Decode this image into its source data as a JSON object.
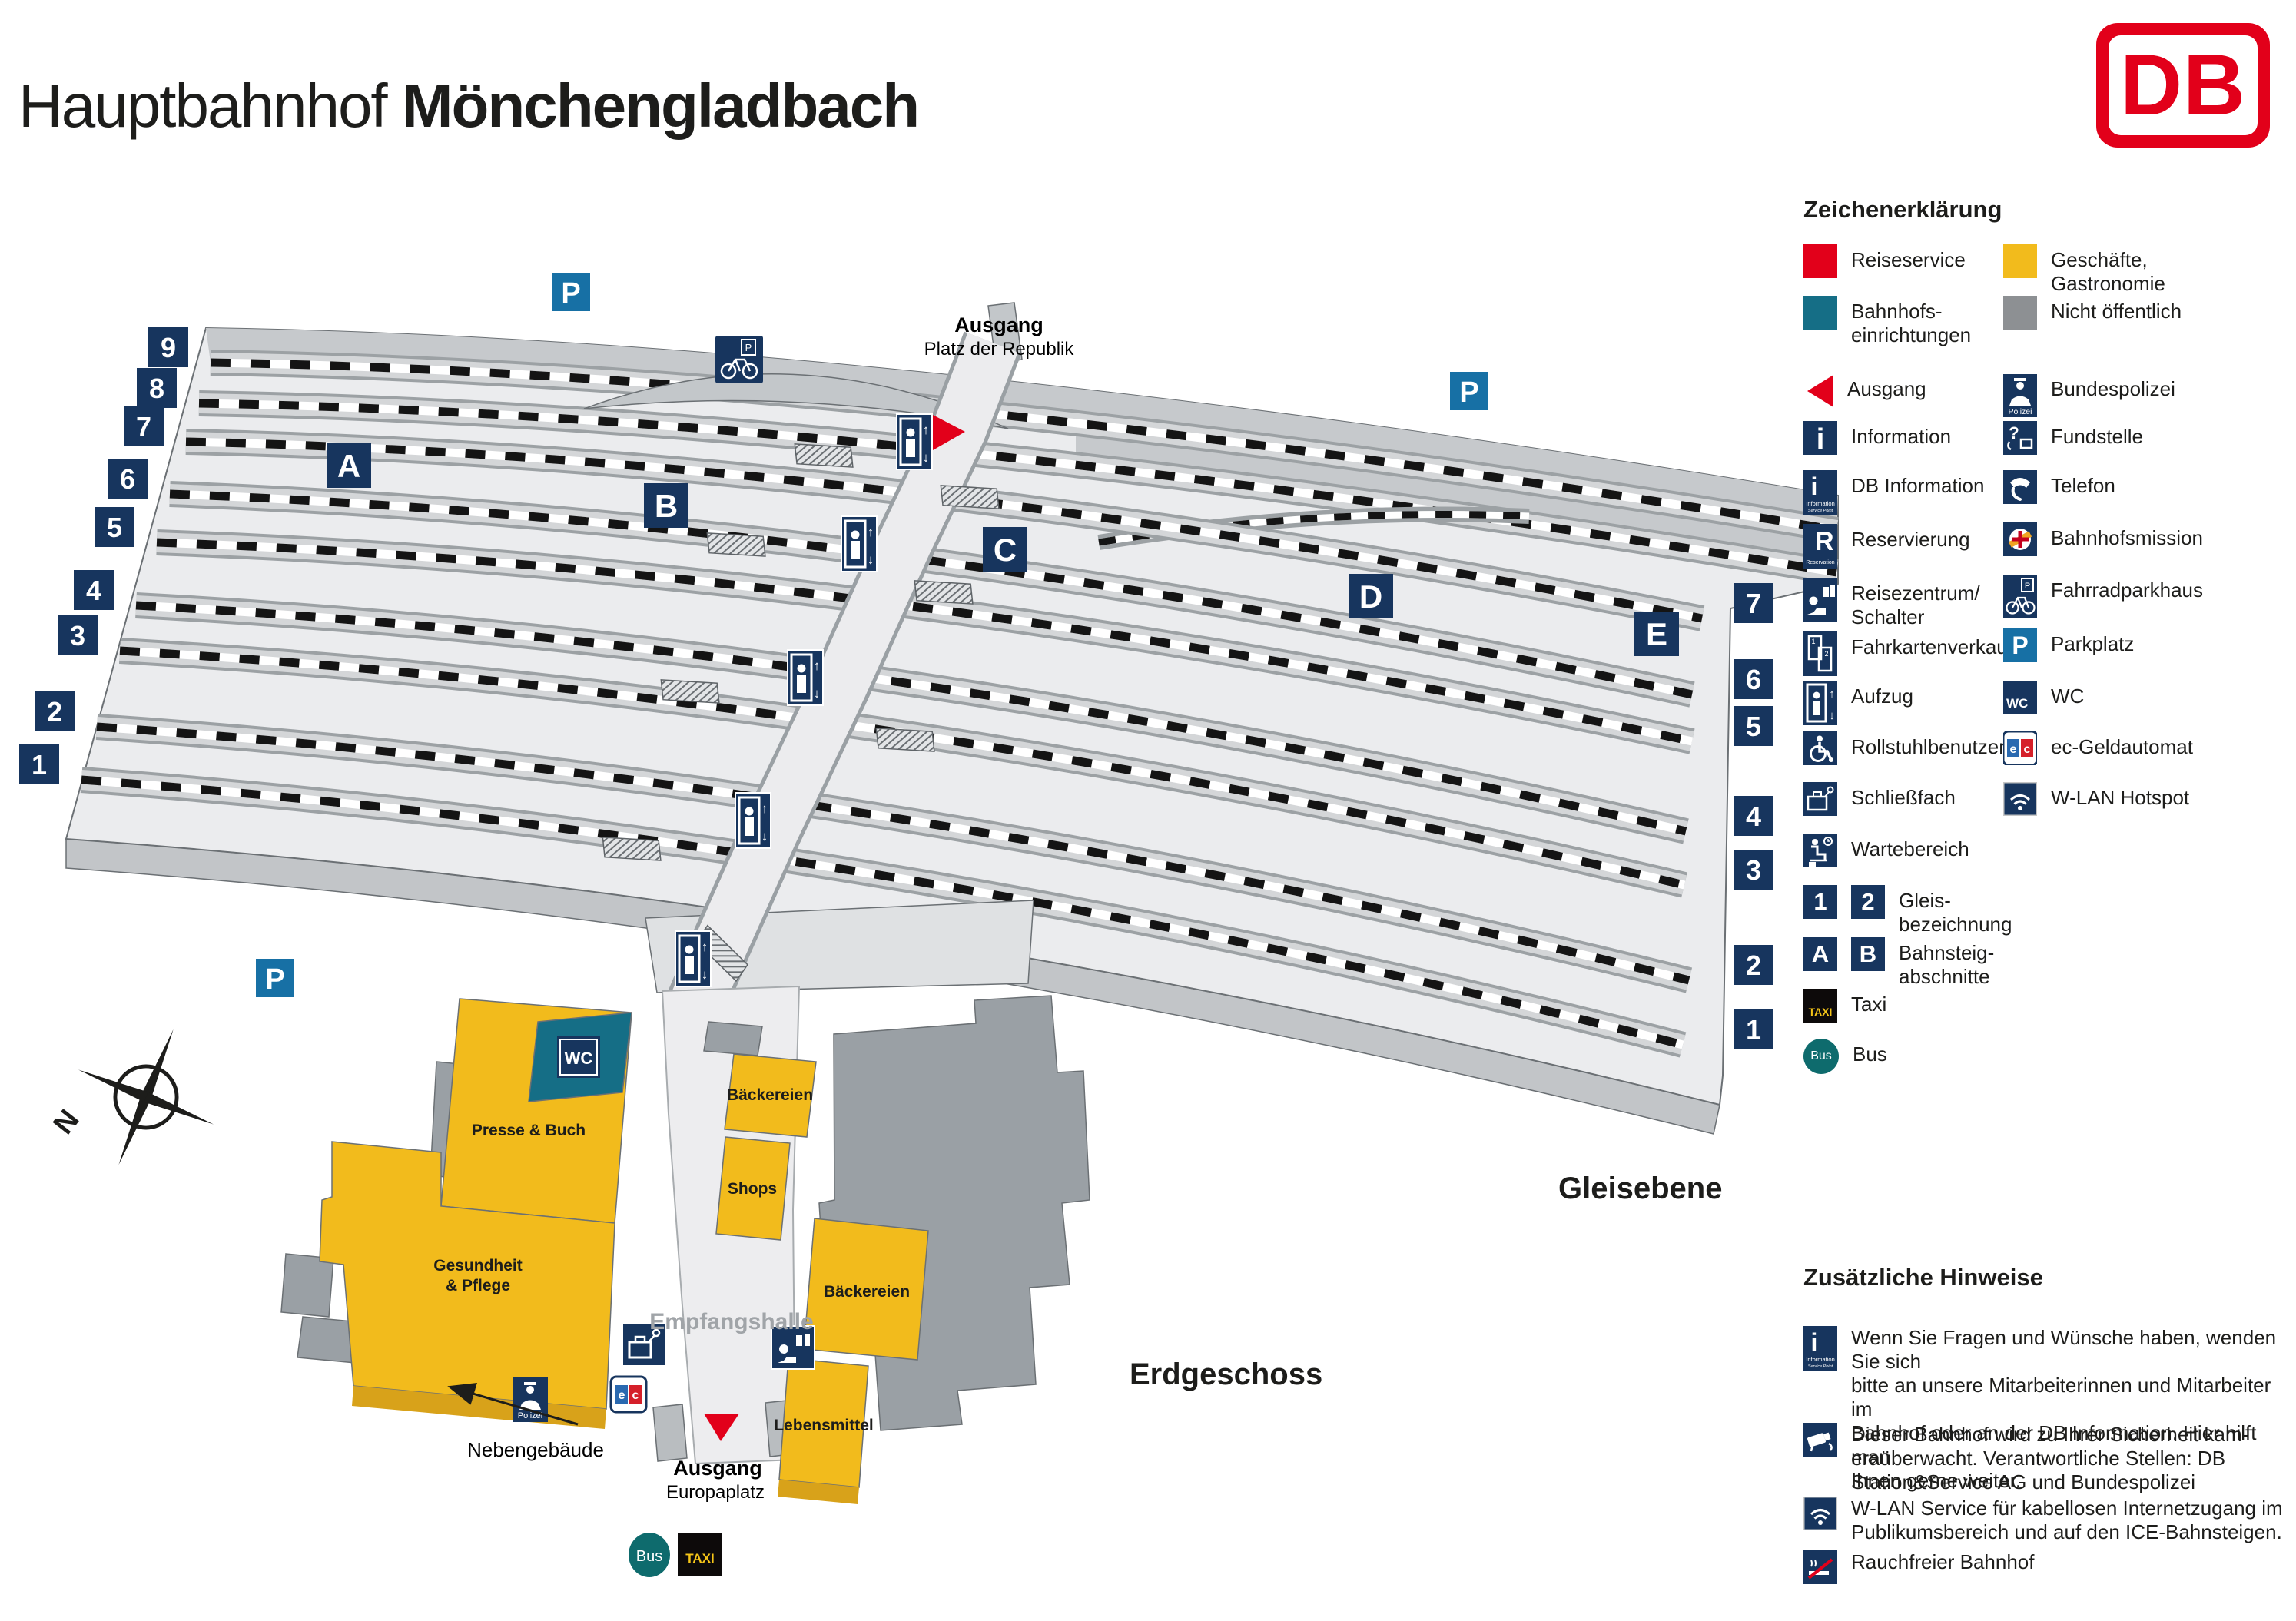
{
  "title": {
    "prefix": "Hauptbahnhof",
    "city": "Mönchengladbach"
  },
  "logo": {
    "text": "DB"
  },
  "legend": {
    "heading": "Zeichenerklärung",
    "micro": {
      "information": "Information",
      "service_point": "Service Point",
      "reservation": "Reservation",
      "polizei": "Polizei",
      "taxi": "TAXI",
      "bus": "Bus",
      "p": "P",
      "wc": "WC",
      "e": "e",
      "c": "c",
      "one": "1",
      "two": "2",
      "a": "A",
      "b": "B",
      "up": "↑",
      "down": "↓",
      "q": "?",
      "i": "i",
      "r": "R"
    },
    "left": [
      {
        "label": "Reiseservice"
      },
      {
        "label": "Bahnhofs-",
        "label2": "einrichtungen"
      },
      {
        "label": "Ausgang"
      },
      {
        "label": "Information"
      },
      {
        "label": "DB Information"
      },
      {
        "label": "Reservierung"
      },
      {
        "label": "Reisezentrum/",
        "label2": "Schalter"
      },
      {
        "label": "Fahrkartenverkauf"
      },
      {
        "label": "Aufzug"
      },
      {
        "label": "Rollstuhlbenutzer"
      },
      {
        "label": "Schließfach"
      },
      {
        "label": "Wartebereich"
      },
      {
        "label": "Gleis-",
        "label2": "bezeichnung"
      },
      {
        "label": "Bahnsteig-",
        "label2": "abschnitte"
      },
      {
        "label": "Taxi"
      },
      {
        "label": "Bus"
      }
    ],
    "right": [
      {
        "label": "Geschäfte,",
        "label2": "Gastronomie"
      },
      {
        "label": "Nicht öffentlich"
      },
      {
        "label": "Bundespolizei"
      },
      {
        "label": "Fundstelle"
      },
      {
        "label": "Telefon"
      },
      {
        "label": "Bahnhofsmission"
      },
      {
        "label": "Fahrradparkhaus"
      },
      {
        "label": "Parkplatz"
      },
      {
        "label": "WC"
      },
      {
        "label": "ec-Geldautomat"
      },
      {
        "label": "W-LAN Hotspot"
      }
    ]
  },
  "notes": {
    "heading": "Zusätzliche Hinweise",
    "items": [
      {
        "lines": [
          "Wenn Sie Fragen und Wünsche haben, wenden Sie sich",
          "bitte an unsere Mitarbeiterinnen und Mitarbeiter im",
          "Bahnhof oder an der DB Information. Hier hilft man",
          "Ihnen gerne weiter."
        ]
      },
      {
        "lines": [
          "Dieser Bahnhof wird zu Ihrer Sicherheit kam-",
          "eraüberwacht. Verantwortliche Stellen: DB",
          "Station&Service AG und Bundespolizei"
        ]
      },
      {
        "lines": [
          "W-LAN Service für kabellosen Internetzugang im",
          "Publikumsbereich und auf den ICE-Bahnsteigen."
        ]
      },
      {
        "lines": [
          "Rauchfreier Bahnhof"
        ]
      }
    ]
  },
  "map": {
    "exit_north": {
      "label": "Ausgang",
      "sub": "Platz der Republik"
    },
    "exit_south": {
      "label": "Ausgang",
      "sub": "Europaplatz"
    },
    "level_tracks": "Gleisebene",
    "level_ground": "Erdgeschoss",
    "hall": "Empfangshalle",
    "neben": "Nebengebäude",
    "shops": {
      "presse": "Presse & Buch",
      "gesundheit1": "Gesundheit",
      "gesundheit2": "& Pflege",
      "baeckereien_nord": "Bäckereien",
      "shops": "Shops",
      "baeckereien_ost": "Bäckereien",
      "lebensmittel": "Lebensmittel"
    },
    "tracks_left": [
      "9",
      "8",
      "7",
      "6",
      "5",
      "4",
      "3",
      "2",
      "1"
    ],
    "tracks_right": [
      "7",
      "6",
      "5",
      "4",
      "3",
      "2",
      "1"
    ],
    "sections": [
      "A",
      "B",
      "C",
      "D",
      "E"
    ],
    "signs": {
      "p": "P",
      "wc": "WC",
      "taxi": "TAXI",
      "bus": "Bus",
      "polizei": "Polizei",
      "north": "N"
    }
  },
  "colors": {
    "red": "#e2001a",
    "navy": "#17355e",
    "blue": "#1770a5",
    "teal": "#156e86",
    "bus_teal": "#0e6b6d",
    "yellow": "#f2bb1c",
    "gray": "#8d9093"
  }
}
